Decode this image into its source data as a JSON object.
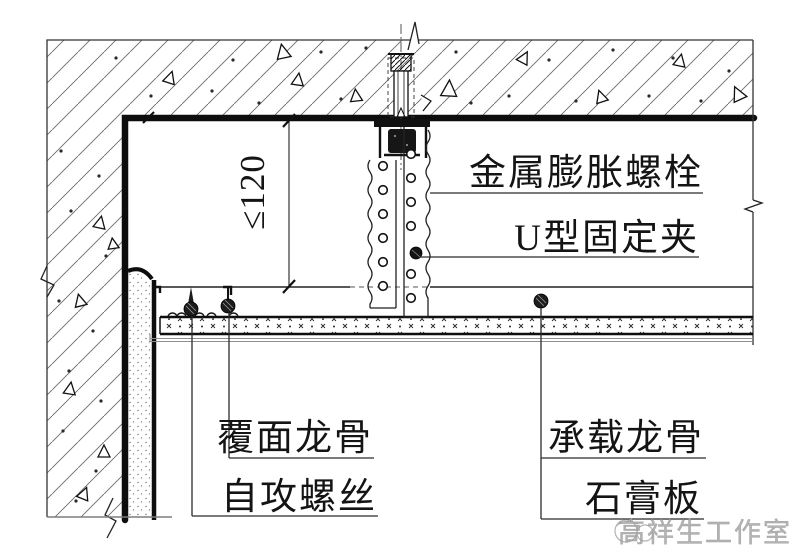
{
  "drawing": {
    "dimension": {
      "value": "≤120"
    },
    "callouts": {
      "expansion_bolt": "金属膨胀螺栓",
      "u_clip": "U型固定夹",
      "furring_channel": "覆面龙骨",
      "self_tapping_screw": "自攻螺丝",
      "carrying_channel": "承载龙骨",
      "gypsum_board": "石膏板"
    },
    "watermark": {
      "text": "高祥生工作室"
    },
    "colors": {
      "line": "#1a1a1a",
      "gray": "#8c8c8c",
      "background": "#ffffff"
    }
  }
}
